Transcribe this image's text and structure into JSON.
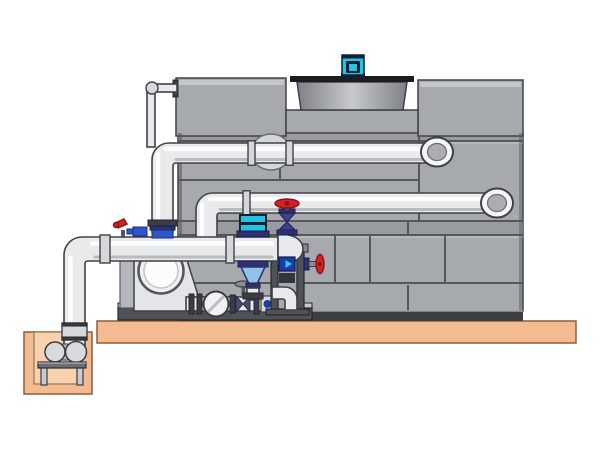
{
  "page": {
    "type": "technical-illustration",
    "description": "Side-view engineering illustration of a factory-assembled cooling tower with fan motor, external return piping, pump manifold with vertical inline pump, isolation and check valves, an end-suction pump volute, and a below-grade sump pump pit on a concrete pad. No text is rendered in the image."
  },
  "scene": {
    "components": [
      {
        "name": "cooling-tower-casing",
        "label": "Cooling tower casing of bolted gray panels"
      },
      {
        "name": "fan-shroud",
        "label": "Fan discharge shroud recessed between roof panels"
      },
      {
        "name": "fan-motor",
        "label": "Cyan fan drive motor on fan deck"
      },
      {
        "name": "upper-return-pipe",
        "label": "Upper hot-water return header with elbow flange into casing"
      },
      {
        "name": "lower-return-pipe",
        "label": "Lower return header with elbow flange into casing"
      },
      {
        "name": "branch-flange",
        "label": "Round branch flange behind upper header"
      },
      {
        "name": "makeup-pipe",
        "label": "Small-bore make-up line at upper left"
      },
      {
        "name": "riser-pipe",
        "label": "Vertical cold-water riser on left face of tower"
      },
      {
        "name": "butterfly-valve-blue",
        "label": "Blue butterfly valve with actuator at riser base"
      },
      {
        "name": "drain-lever-valve",
        "label": "Small red lever drain valve on manifold"
      },
      {
        "name": "pump-manifold",
        "label": "Horizontal suction manifold with domed end cap"
      },
      {
        "name": "inline-pump",
        "label": "Vertical inline pump with cyan motor and blue bowl"
      },
      {
        "name": "globe-valve-red",
        "label": "Red handwheel globe valve on manifold end"
      },
      {
        "name": "valve-column",
        "label": "Instrument stand with blue flow device and drain elbow"
      },
      {
        "name": "side-red-valve",
        "label": "Red handwheel drain valve on instrument stand"
      },
      {
        "name": "volute-pump",
        "label": "End-suction pump volute with circular inlet"
      },
      {
        "name": "check-valve",
        "label": "Wafer check valve in discharge run"
      },
      {
        "name": "gate-valve",
        "label": "Small gate valve with stem handwheel"
      },
      {
        "name": "equipment-skid",
        "label": "Steel equipment skid rail"
      },
      {
        "name": "concrete-pad",
        "label": "Concrete housekeeping pad"
      },
      {
        "name": "sump-pit",
        "label": "Below-grade sump pit"
      },
      {
        "name": "sump-pump",
        "label": "Sump pump and motor on steel stand"
      },
      {
        "name": "suction-pipe",
        "label": "Vertical suction pipe from sump to manifold"
      }
    ]
  },
  "colors": {
    "background": "#ffffff",
    "panel_gray": "#a6a9ae",
    "panel_gray_dark": "#989ba0",
    "panel_bevel": "#c3c6ca",
    "seam_dark": "#54575c",
    "outline": "#3f4146",
    "base_dark": "#3c3e42",
    "shroud_edge": "#7e8187",
    "shroud_light": "#c6c9cd",
    "fan_deck": "#1b1c1e",
    "motor_cyan": "#25c2e7",
    "motor_navy": "#13202e",
    "pipe_flat": "#e9eaec",
    "pipe_mid": "#d5d7da",
    "flange_dark": "#3a3d46",
    "ground_peach": "#f4bb90",
    "ground_peach_light": "#f8d2ae",
    "ground_outline": "#8a5f3e",
    "valve_red": "#d42127",
    "valve_red_dark": "#8a1518",
    "valve_navy": "#2e3170",
    "valve_purple": "#3d3f8f",
    "valve_blue": "#2f55cc",
    "device_blue": "#1d3ba8",
    "arrow_cyan": "#35c7e8",
    "pump_bowl_blue": "#8fc4e4",
    "frame_gray": "#4f5257",
    "steel_light": "#c6c8cb"
  }
}
